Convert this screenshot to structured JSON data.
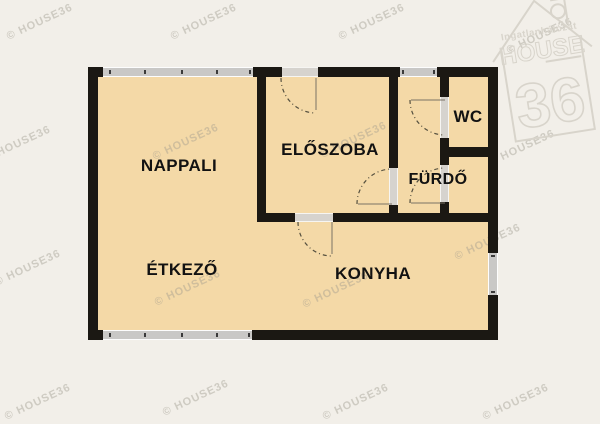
{
  "canvas": {
    "width": 600,
    "height": 424,
    "background": "#f2efe9"
  },
  "watermark": {
    "text": "© HOUSE36",
    "color": "rgba(158,152,140,0.42)",
    "rotation_deg": -25,
    "positions": [
      [
        4,
        16
      ],
      [
        168,
        16
      ],
      [
        336,
        16
      ],
      [
        504,
        30
      ],
      [
        -18,
        138
      ],
      [
        150,
        136
      ],
      [
        318,
        134
      ],
      [
        486,
        142
      ],
      [
        -8,
        262
      ],
      [
        152,
        282
      ],
      [
        300,
        284
      ],
      [
        452,
        236
      ],
      [
        2,
        396
      ],
      [
        160,
        392
      ],
      [
        320,
        396
      ],
      [
        480,
        396
      ]
    ]
  },
  "logo": {
    "brand_small": "Ingatlanhálózat",
    "brand_main": "HOUSE",
    "brand_number": "36",
    "color": "#d8d4cb"
  },
  "floorplan": {
    "colors": {
      "floor": "#f4d9a7",
      "wall": "#1b1813",
      "window": "#c9c8c6",
      "door_opening": "#d6d3ce",
      "door_swing": "#55503f",
      "label": "#121212"
    },
    "rooms": [
      {
        "id": "nappali",
        "label": "NAPPALI"
      },
      {
        "id": "eloszoba",
        "label": "ELŐSZOBA"
      },
      {
        "id": "wc",
        "label": "WC"
      },
      {
        "id": "furdo",
        "label": "FÜRDŐ"
      },
      {
        "id": "etkezo",
        "label": "ÉTKEZŐ"
      },
      {
        "id": "konyha",
        "label": "KONYHA"
      }
    ]
  }
}
